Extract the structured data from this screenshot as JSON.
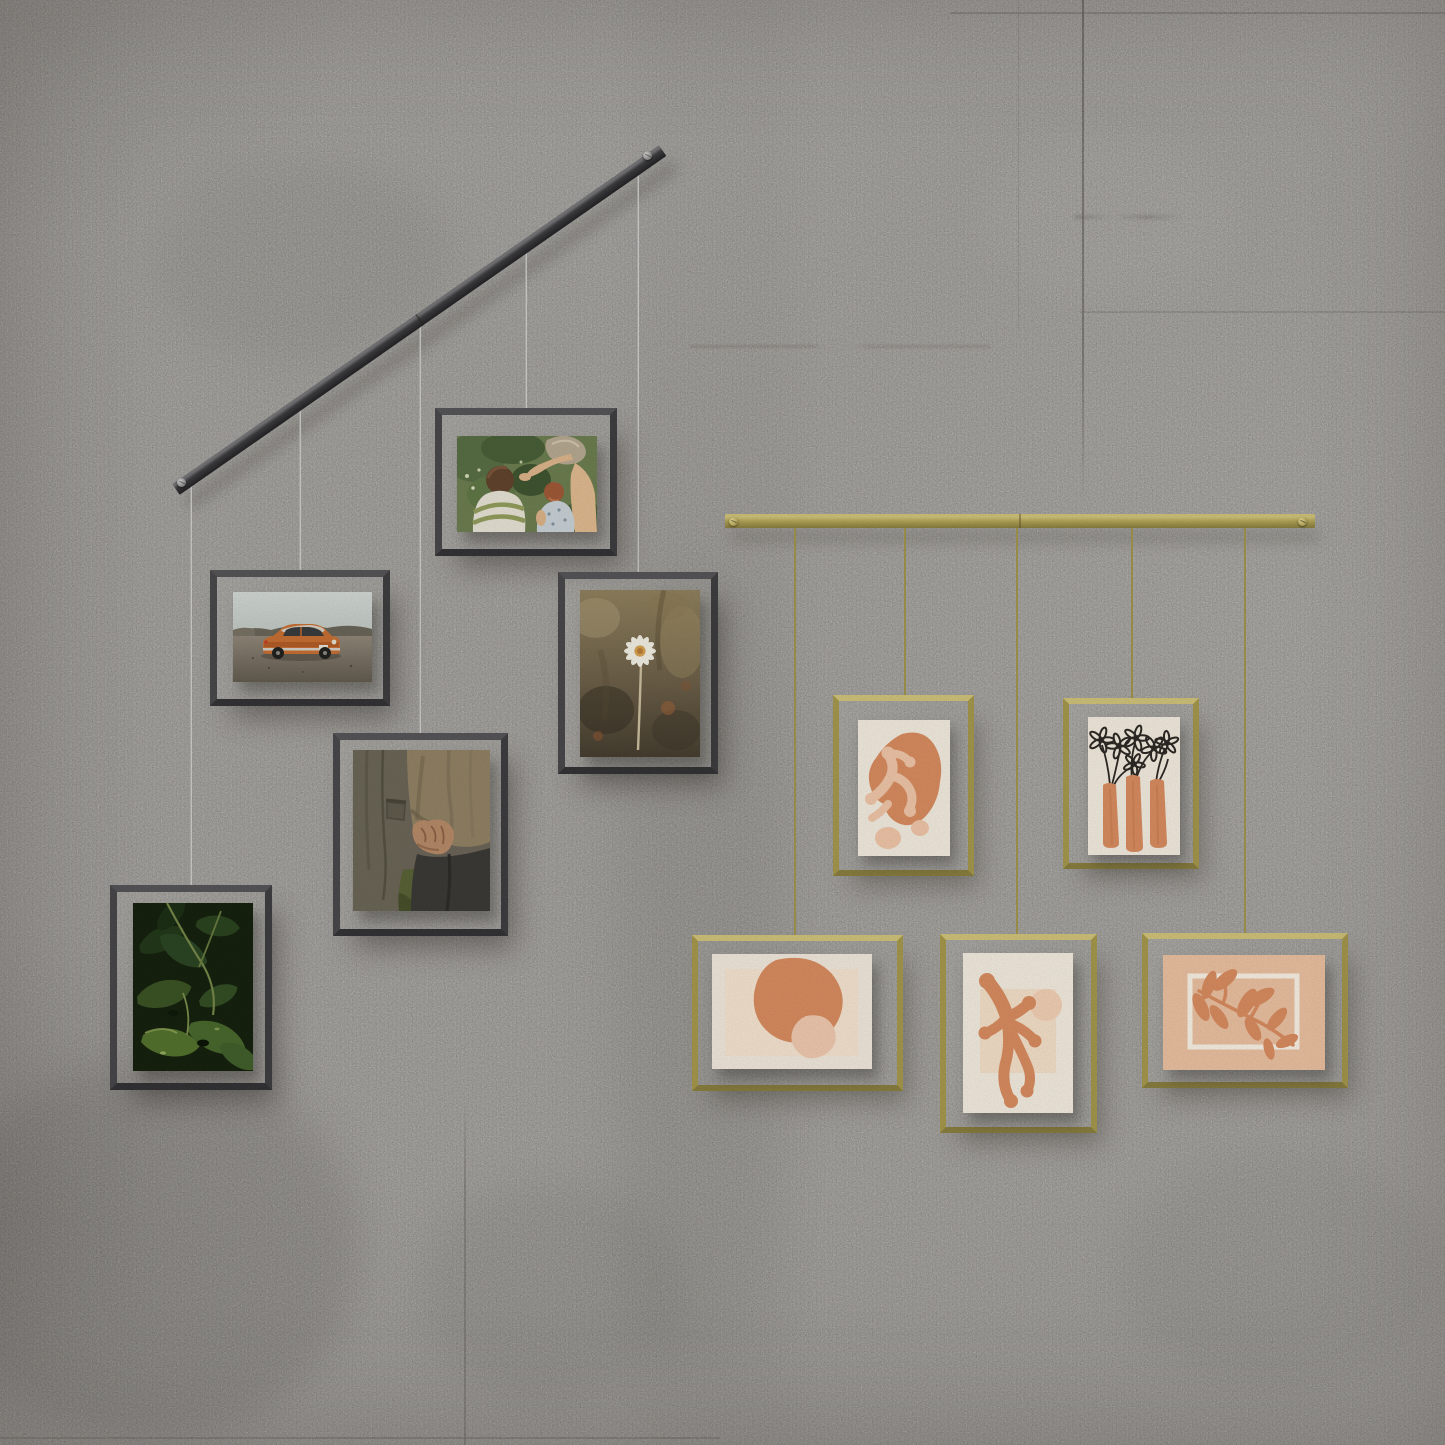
{
  "scene": {
    "title": "Two cable-hung gallery photo displays on a gray concrete wall",
    "wall": {
      "material": "concrete panels",
      "description": "Light gray concrete wall with vertical panel seams, streaks and soft stains"
    },
    "left_display": {
      "label": "black cable photo display",
      "rail": "black metal bar mounted diagonally with a screw at each end",
      "wires": "5 thin steel cables",
      "frames": [
        {
          "id": "kids-garden",
          "orientation": "landscape",
          "description": "Snapshot of two children and an adult reaching into green garden foliage"
        },
        {
          "id": "orange-car",
          "orientation": "landscape",
          "description": "Vintage orange sedan parked on a gravel plain under a pale sky"
        },
        {
          "id": "white-daisy",
          "orientation": "portrait",
          "description": "Single white daisy on a tall stem against a blurred brown meadow"
        },
        {
          "id": "holding-hands",
          "orientation": "portrait",
          "description": "Two people in utility jackets holding hands"
        },
        {
          "id": "green-leaves",
          "orientation": "portrait",
          "description": "Close-up of overlapping dark green leaves"
        }
      ]
    },
    "right_display": {
      "label": "brass cable art display",
      "rail": "brass bar mounted horizontally with a screw at each end",
      "wires": "5 brass cables",
      "frames": [
        {
          "id": "coral-cutout",
          "orientation": "portrait",
          "description": "Terracotta blob with peach coral cut-out shapes on cream paper"
        },
        {
          "id": "flower-vases",
          "orientation": "portrait",
          "description": "Three terracotta vases holding black sketched flowers on cream paper"
        },
        {
          "id": "terracotta-egg",
          "orientation": "landscape",
          "description": "Large tilted terracotta oval with a small peach blob on cream paper"
        },
        {
          "id": "coral-branch",
          "orientation": "portrait",
          "description": "Terracotta branching coral shape with a peach circle on cream paper"
        },
        {
          "id": "leaf-outline",
          "orientation": "landscape",
          "description": "Terracotta leafy sprig over a white outlined rectangle on peach paper"
        }
      ]
    },
    "palette": {
      "wall": "#bdbab4",
      "wall_light": "#cac7c1",
      "wall_dark": "#a8a59f",
      "rail_black": "#323234",
      "frame_dark": "#48484b",
      "wire_steel": "#e9e9e7",
      "brass": "#b2a457",
      "brass_light": "#d3c67c",
      "brass_dark": "#8c8040",
      "frame_brass": "#a89b4e",
      "terracotta": "#dc8e61",
      "peach": "#f3c9ab",
      "cream_paper": "#f7efe2",
      "peach_paper": "#eec3a3",
      "ink_black": "#2e2a26"
    }
  }
}
